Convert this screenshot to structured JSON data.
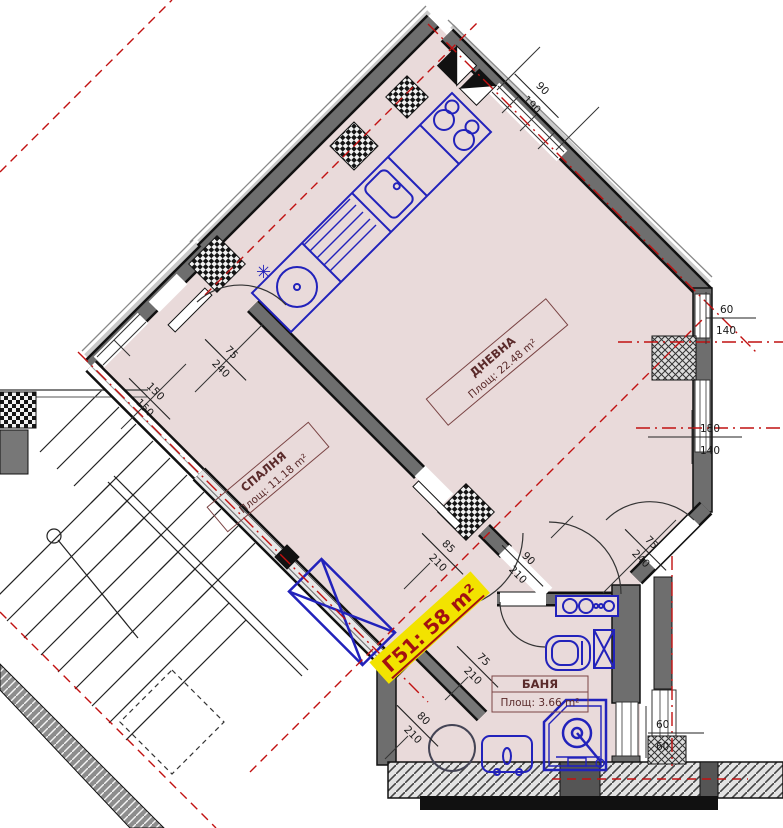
{
  "plan": {
    "unit": {
      "label": "Г51: 58 m²"
    },
    "rooms": {
      "living": {
        "name": "ДНЕВНА",
        "area": "Площ: 22.48 m²"
      },
      "bedroom": {
        "name": "СПАЛНЯ",
        "area": "Площ: 11.18 m²"
      },
      "bath": {
        "name": "БАНЯ",
        "area": "Площ: 3.66 m²"
      }
    },
    "dims": {
      "win_top": {
        "w": "90",
        "h": "190"
      },
      "win_right_upper": {
        "w": "60",
        "h": "140"
      },
      "win_right_lower": {
        "w": "180",
        "h": "140"
      },
      "door_bedroom": {
        "w": "75",
        "h": "240"
      },
      "win_left": {
        "w": "150",
        "h": "150"
      },
      "door_bedroom_hall": {
        "w": "85",
        "h": "210"
      },
      "door_living_hall": {
        "w": "90",
        "h": "210"
      },
      "door_living_right": {
        "w": "75",
        "h": "240"
      },
      "door_bath": {
        "w": "75",
        "h": "210"
      },
      "door_entry": {
        "w": "80",
        "h": "210"
      },
      "win_bath": {
        "w": "60",
        "h": "60"
      }
    },
    "symbols": {
      "kitchen_asterisk": "✳"
    },
    "colors": {
      "interior": "#e9dada",
      "wall": "#6e6e6e",
      "fixtures": "#2222bb",
      "axis": "#c11111",
      "label_text": "#5a2a2a",
      "unit_highlight": "#f2e300",
      "unit_text": "#a31111"
    }
  }
}
